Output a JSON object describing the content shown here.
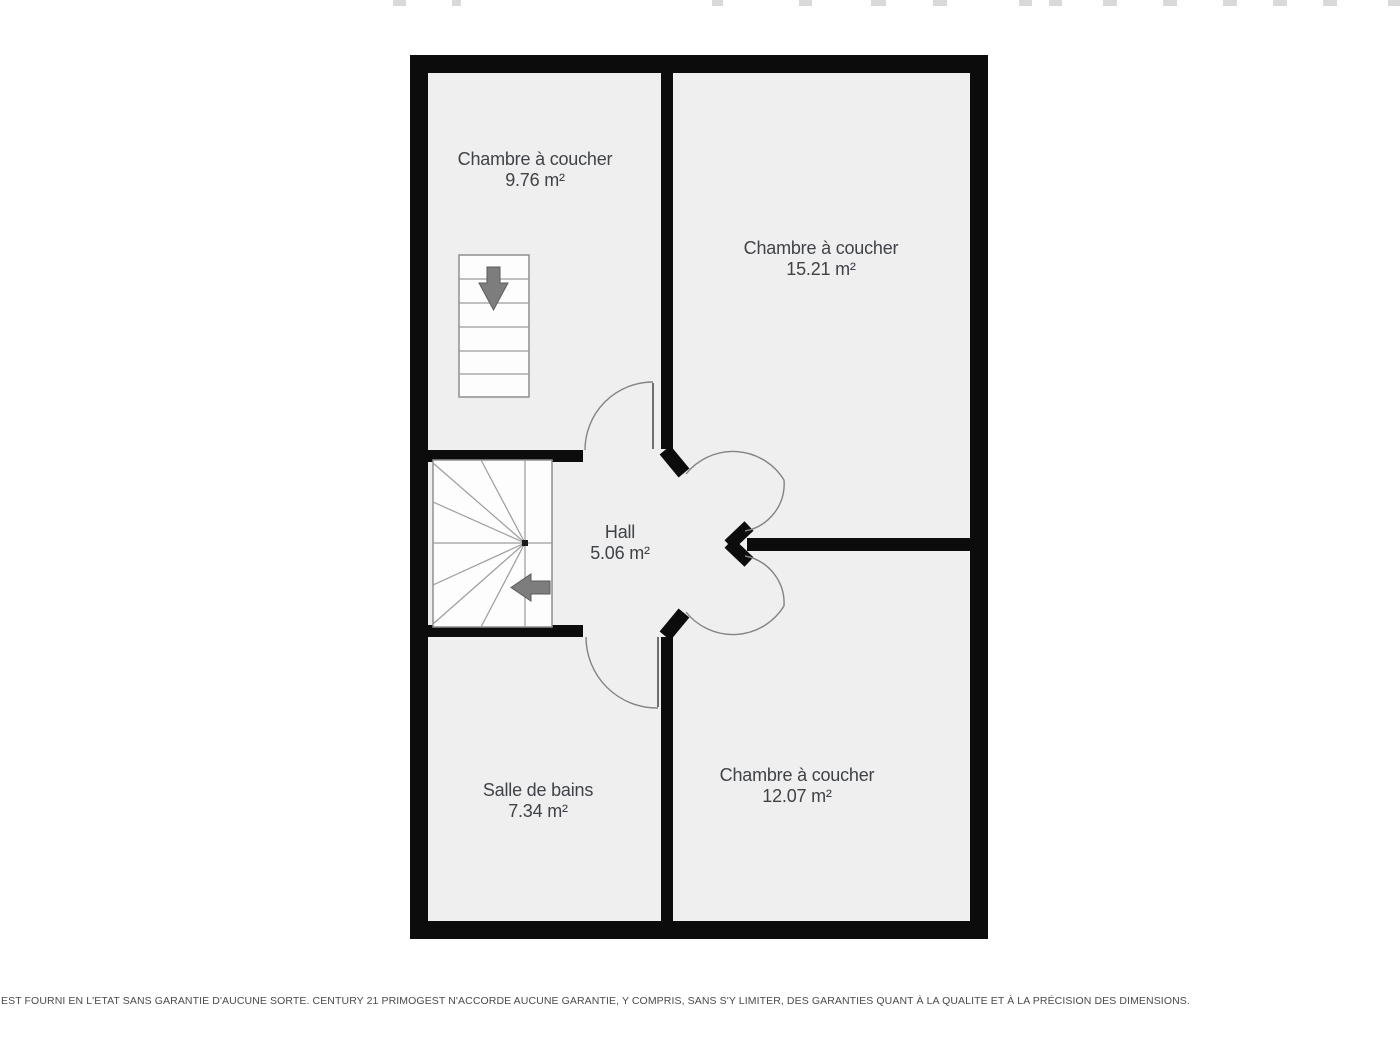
{
  "floorplan": {
    "rooms": [
      {
        "id": "bedroom-1",
        "name": "Chambre à coucher",
        "area": "9.76 m²"
      },
      {
        "id": "bedroom-2",
        "name": "Chambre à coucher",
        "area": "15.21 m²"
      },
      {
        "id": "hall",
        "name": "Hall",
        "area": "5.06 m²"
      },
      {
        "id": "bathroom",
        "name": "Salle de bains",
        "area": "7.34 m²"
      },
      {
        "id": "bedroom-3",
        "name": "Chambre à coucher",
        "area": "12.07 m²"
      }
    ],
    "icons": [
      {
        "name": "stairs-down-arrow",
        "meaning": "descending straight staircase direction"
      },
      {
        "name": "stairs-left-arrow",
        "meaning": "winder staircase direction"
      }
    ],
    "colors": {
      "wall": "#0c0c0c",
      "room_fill": "#efefef",
      "stair_fill": "#fdfdfd",
      "stair_line": "#9c9c9c",
      "door_arc": "#838383",
      "arrow": "#7d7d7d",
      "label_text": "#3f4347",
      "page_background": "#ffffff"
    }
  },
  "disclaimer": {
    "text": "EST FOURNI EN L'ETAT SANS GARANTIE D'AUCUNE SORTE. CENTURY 21 PRIMOGEST N'ACCORDE AUCUNE GARANTIE, Y COMPRIS, SANS S'Y LIMITER, DES GARANTIES QUANT À LA QUALITE ET À LA PRÉCISION DES DIMENSIONS."
  },
  "top_edge_marks": [
    {
      "x": 393,
      "w": 13
    },
    {
      "x": 452,
      "w": 9
    },
    {
      "x": 712,
      "w": 11
    },
    {
      "x": 799,
      "w": 13
    },
    {
      "x": 871,
      "w": 15
    },
    {
      "x": 933,
      "w": 14
    },
    {
      "x": 1019,
      "w": 13
    },
    {
      "x": 1049,
      "w": 13
    },
    {
      "x": 1103,
      "w": 14
    },
    {
      "x": 1163,
      "w": 14
    },
    {
      "x": 1223,
      "w": 14
    },
    {
      "x": 1273,
      "w": 14
    },
    {
      "x": 1323,
      "w": 14
    },
    {
      "x": 1388,
      "w": 12
    }
  ]
}
